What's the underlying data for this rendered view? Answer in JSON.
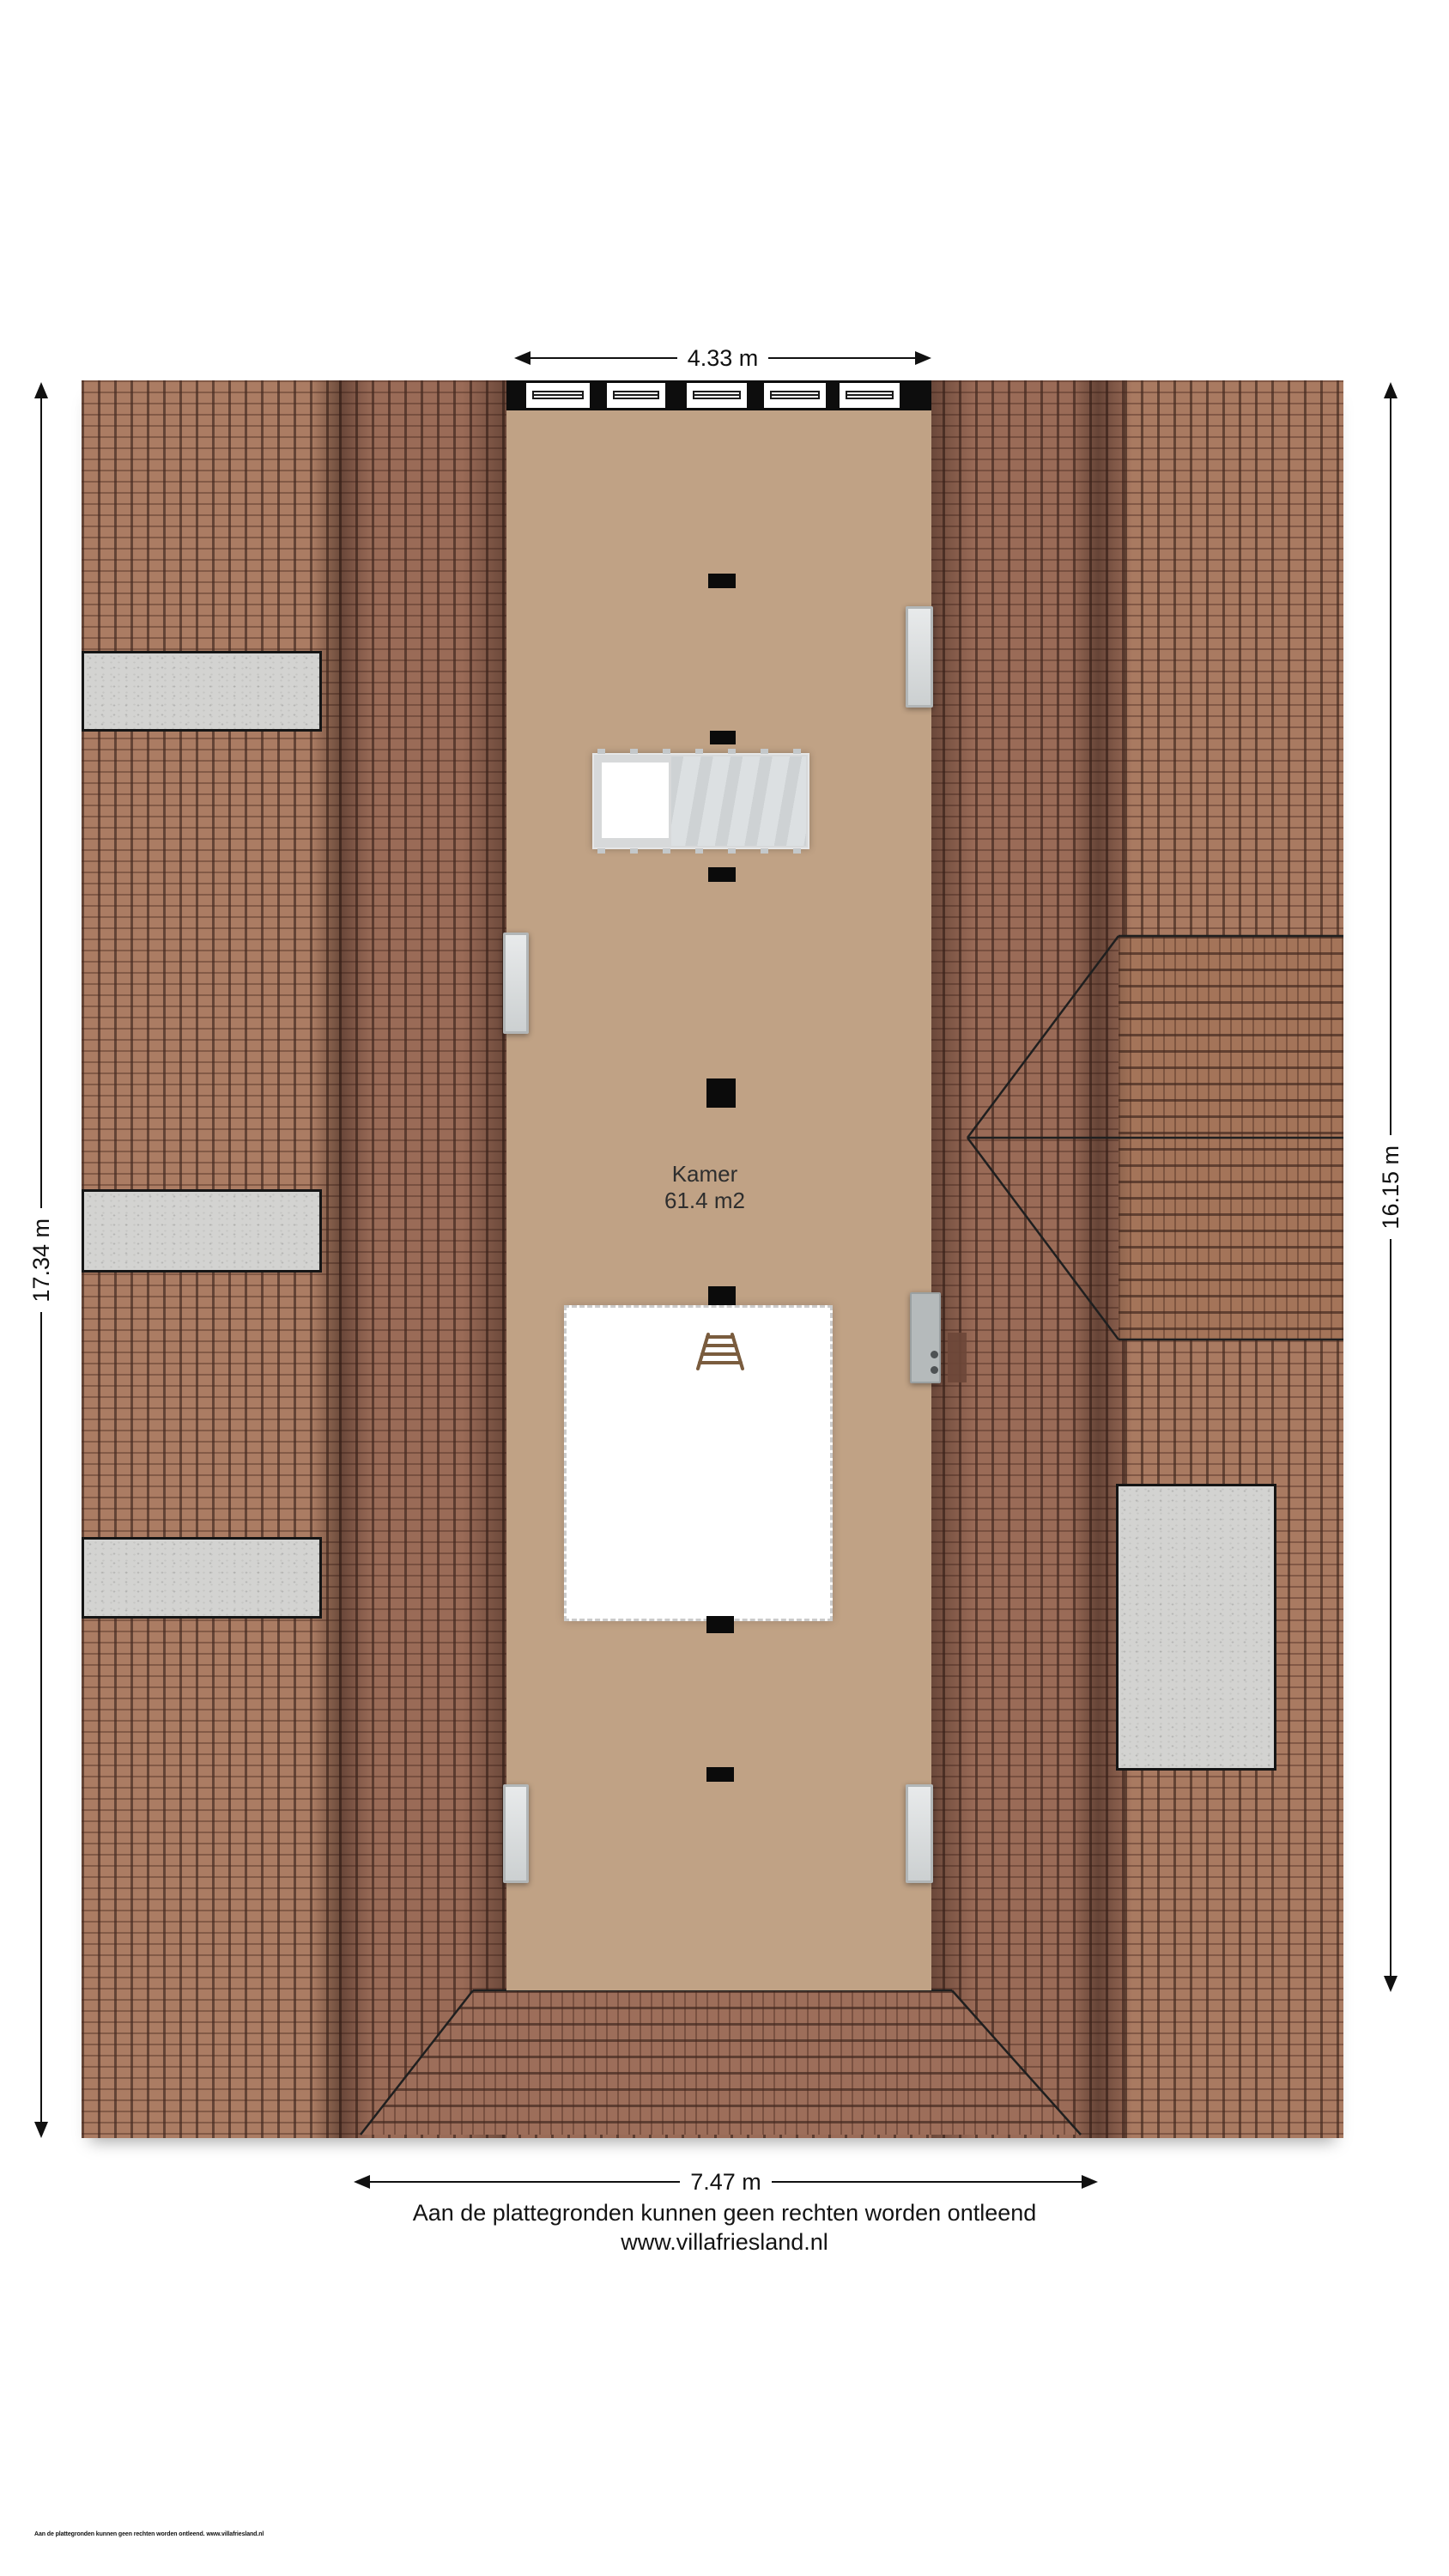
{
  "plan": {
    "room": {
      "name": "Kamer",
      "area": "61.4 m2"
    }
  },
  "dimensions": {
    "top": "4.33 m",
    "left": "17.34 m",
    "right": "16.15 m",
    "bottom": "7.47 m"
  },
  "footer": {
    "disclaimer": "Aan de plattegronden kunnen geen rechten worden ontleend",
    "website": "www.villafriesland.nl",
    "fineprint": "Aan de plattegronden kunnen geen rechten worden ontleend. www.villafriesland.nl"
  },
  "colors": {
    "floor": "#c0a285",
    "wall": "#0d0d0d",
    "roof_tile": "#9a6b57",
    "roof_tile_light": "#ab7c63",
    "roof_tile_light2": "#a97a61",
    "roof_tile_rot": "#a47459",
    "roof_tile_hip": "#9d6e5a",
    "concrete": "#d3d3d1"
  }
}
